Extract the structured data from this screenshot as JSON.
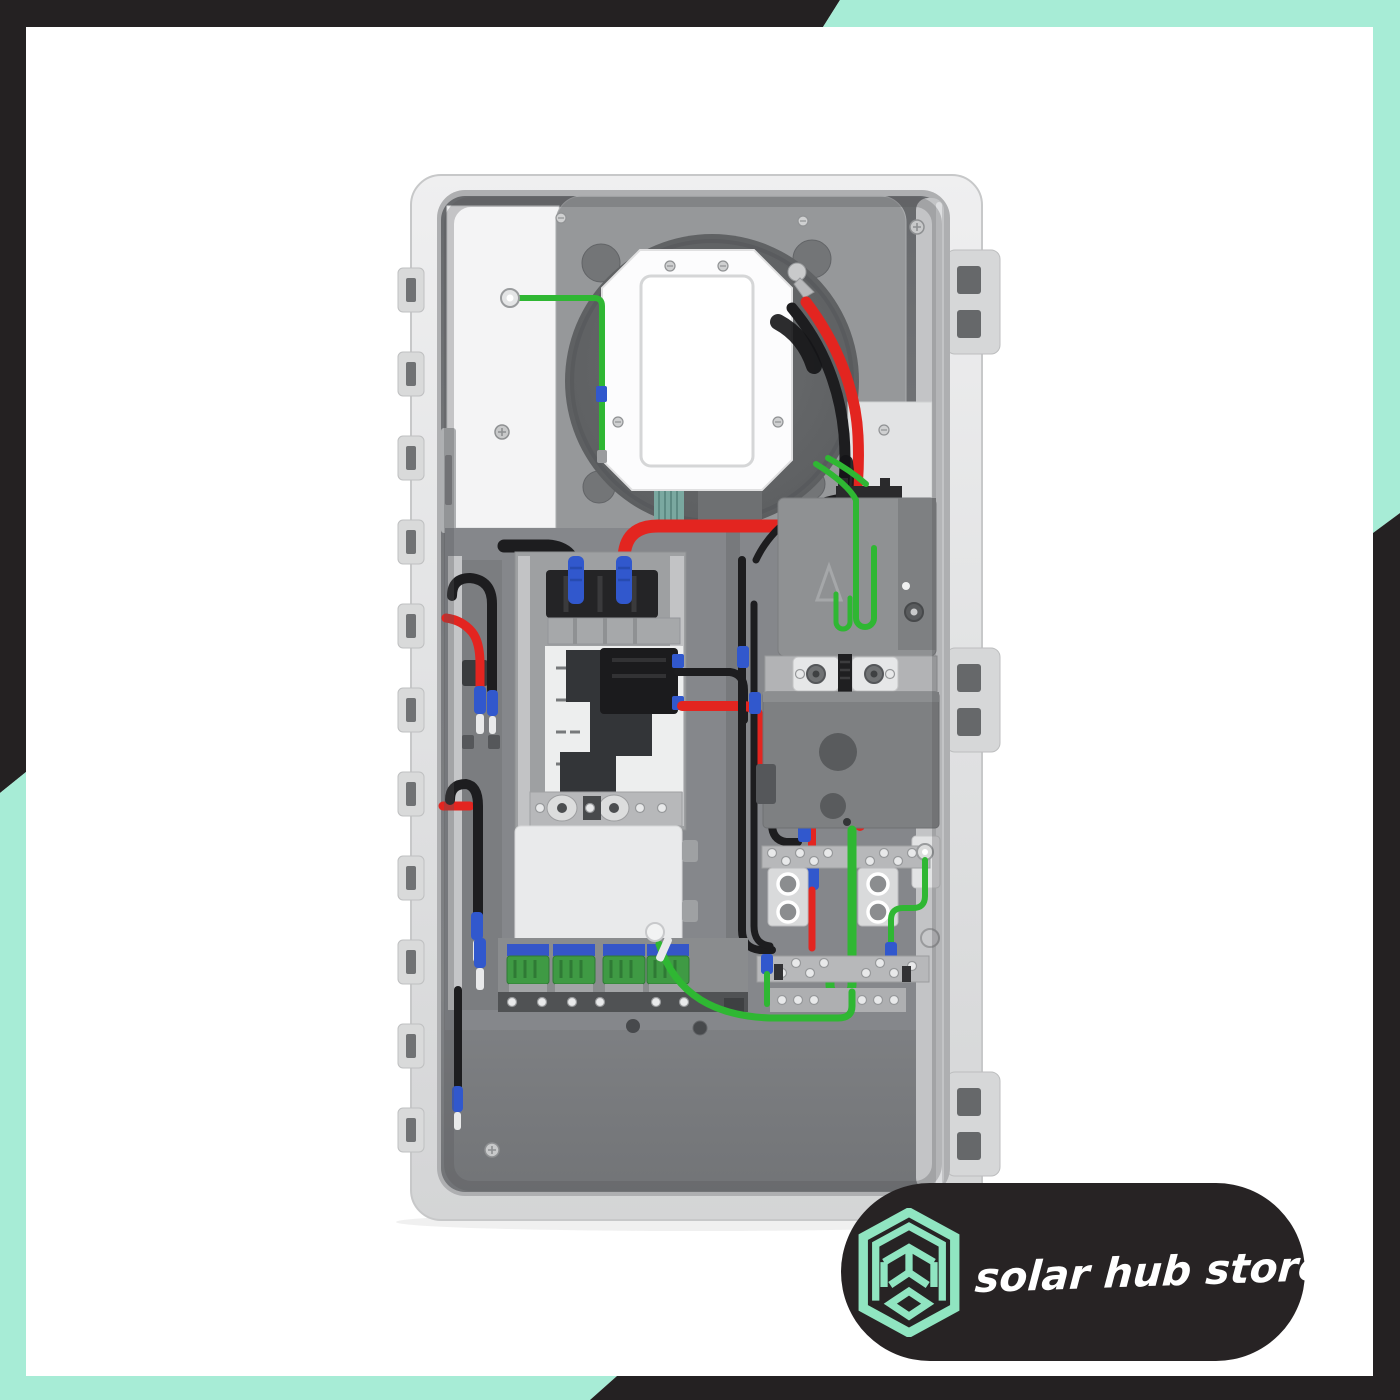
{
  "badge": {
    "text": "solar hub store",
    "logo_icon": "hexagon-cube-icon"
  },
  "product": {
    "description": "Open solar backup gateway load center showing internal wiring, breakers, contactor and busbars",
    "wire_colors": [
      "red",
      "black",
      "green"
    ],
    "connector_color": "blue"
  },
  "colors": {
    "page_white": "#ffffff",
    "frame_black": "#242122",
    "accent_mint": "#a7ecd6",
    "logo_mint": "#90e5c1",
    "badge_black": "#272324",
    "shell_light": "#e3e4e5",
    "shell_edge": "#c7c8c9",
    "cavity_dark": "#6b6d70",
    "plate_gray": "#96989a",
    "circle_dark": "#616365",
    "panel_white": "#f4f4f5",
    "cover_white": "#e9eaeb",
    "box_gray": "#8f9193",
    "box_gray_dark": "#7e8082",
    "metal_gray": "#b7b8ba",
    "wire_red": "#e32520",
    "wire_black": "#1d1d1f",
    "wire_green": "#2fb733",
    "ferrule_blue": "#3158cd",
    "terminal_green": "#3f9a44"
  }
}
